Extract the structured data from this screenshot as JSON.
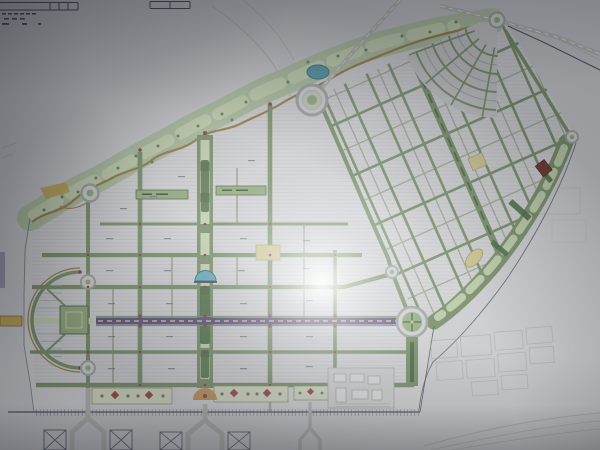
{
  "scene": {
    "description": "Photograph of a printed city master plan drawing with gridded districts, green boulevards, a purple central avenue, roundabouts and a landscaped park corridor; camera flash glare at center",
    "legible_text": "none"
  },
  "colors": {
    "street_green": "#74905e",
    "street_minor": "#9fab92",
    "green_dark": "#3f6b35",
    "green_fill": "#8fae72",
    "park_band": "#a9c295",
    "park_band_light": "#c6d8ab",
    "road_brown": "#9c7c34",
    "road_yellow": "#c9a63c",
    "highway": "#b4b8b2",
    "avenue_purple": "#57498e",
    "avenue_dash": "#d8c84a",
    "water": "#3a98a8",
    "water_light": "#56b0c4",
    "tree": "#5d8050",
    "block_red": "#742e24",
    "block_yellow": "#d3cb82",
    "marker_red": "#8a3c38",
    "ring_gray": "#9fa3a0",
    "paper_light": "#d2d4d3",
    "boundary": "#4a4f58",
    "faint": "#a8abae",
    "ink": "#3a4252",
    "lavender": "#8a84a8",
    "parterre_bg": "#d8dfc0",
    "parterre_red": "#a04038",
    "fountain_orange": "#c98a3a"
  },
  "map_features": [
    {
      "id": "title-block",
      "label": "drawing title block fragment"
    },
    {
      "id": "northwest-park-band",
      "label": "landscaped park corridor with meandering road"
    },
    {
      "id": "pond",
      "label": "pond in park corridor"
    },
    {
      "id": "central-ring-roundabout",
      "label": "large concentric roundabout"
    },
    {
      "id": "top-roundabout",
      "label": "small roundabout at north apex"
    },
    {
      "id": "fan-district",
      "label": "radial fan street district"
    },
    {
      "id": "diagonal-district",
      "label": "rotated grid district"
    },
    {
      "id": "east-green-spine",
      "label": "linear park spine with civic blocks"
    },
    {
      "id": "west-grid-district",
      "label": "orthogonal residential grid"
    },
    {
      "id": "central-mall",
      "label": "wide green mall boulevard"
    },
    {
      "id": "purple-avenue",
      "label": "main east-west avenue"
    },
    {
      "id": "west-crescent",
      "label": "semicircular crescent quarter"
    },
    {
      "id": "east-green-roundabout",
      "label": "large green roundabout"
    },
    {
      "id": "parterre-gardens",
      "label": "formal garden parterres"
    },
    {
      "id": "boundary-band",
      "label": "hatched southern boundary band"
    },
    {
      "id": "flash-glare",
      "label": "camera flash reflection"
    }
  ]
}
